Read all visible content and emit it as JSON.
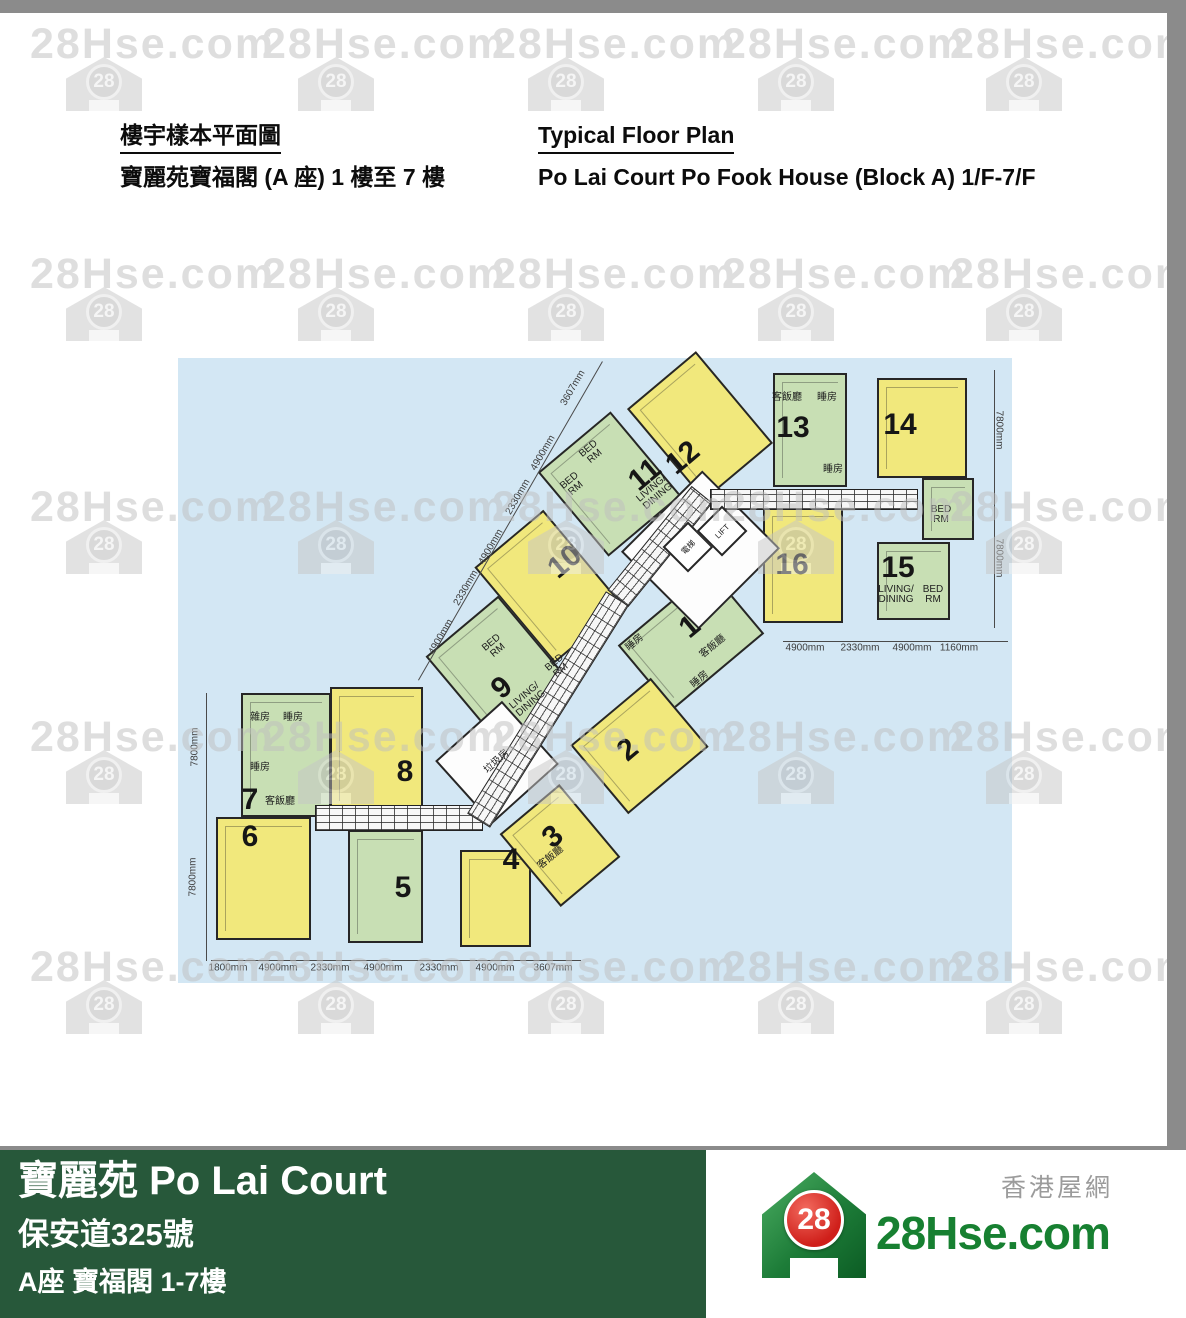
{
  "header": {
    "title_zh": "樓宇樣本平面圖",
    "subtitle_zh": "寶麗苑寶福閣 (A 座) 1 樓至 7 樓",
    "title_en": "Typical Floor Plan",
    "subtitle_en": "Po Lai Court Po Fook House (Block A) 1/F-7/F"
  },
  "watermark": {
    "text": "28Hse.com",
    "badge": "28",
    "cols": [
      30,
      262,
      492,
      722,
      950
    ],
    "rows": [
      20,
      250,
      483,
      713,
      943
    ]
  },
  "plan": {
    "bg": "#d3e7f4",
    "colors": {
      "yellow": "#f1e87c",
      "green": "#c8dfb4"
    },
    "units": [
      {
        "id": "7",
        "color": "green",
        "x": 63,
        "y": 335,
        "w": 90,
        "h": 124,
        "rot": 0
      },
      {
        "id": "6",
        "color": "yellow",
        "x": 38,
        "y": 459,
        "w": 95,
        "h": 123,
        "rot": 0
      },
      {
        "id": "8",
        "color": "yellow",
        "x": 152,
        "y": 329,
        "w": 93,
        "h": 123,
        "rot": 0
      },
      {
        "id": "5",
        "color": "green",
        "x": 170,
        "y": 472,
        "w": 75,
        "h": 113,
        "rot": 0
      },
      {
        "id": "4",
        "color": "yellow",
        "x": 282,
        "y": 492,
        "w": 71,
        "h": 97,
        "rot": 0
      },
      {
        "id": "13",
        "color": "green",
        "x": 595,
        "y": 15,
        "w": 74,
        "h": 114,
        "rot": 0
      },
      {
        "id": "14",
        "color": "yellow",
        "x": 699,
        "y": 20,
        "w": 90,
        "h": 100,
        "rot": 0
      },
      {
        "id": "14b",
        "color": "green",
        "x": 744,
        "y": 120,
        "w": 52,
        "h": 62,
        "rot": 0
      },
      {
        "id": "16",
        "color": "yellow",
        "x": 585,
        "y": 149,
        "w": 80,
        "h": 116,
        "rot": 0
      },
      {
        "id": "15",
        "color": "green",
        "x": 699,
        "y": 184,
        "w": 73,
        "h": 78,
        "rot": 0
      },
      {
        "id": "12",
        "color": "yellow",
        "cx": 522,
        "cy": 68,
        "w": 90,
        "h": 120,
        "rot": -40
      },
      {
        "id": "11",
        "color": "green",
        "cx": 431,
        "cy": 126,
        "w": 95,
        "h": 110,
        "rot": -40
      },
      {
        "id": "10",
        "color": "yellow",
        "cx": 371,
        "cy": 228,
        "w": 90,
        "h": 125,
        "rot": -40
      },
      {
        "id": "9",
        "color": "green",
        "cx": 322,
        "cy": 314,
        "w": 95,
        "h": 120,
        "rot": -40
      },
      {
        "id": "1",
        "color": "green",
        "cx": 513,
        "cy": 281,
        "w": 120,
        "h": 85,
        "rot": -40
      },
      {
        "id": "2",
        "color": "yellow",
        "cx": 461,
        "cy": 388,
        "w": 105,
        "h": 90,
        "rot": -40
      },
      {
        "id": "3",
        "color": "yellow",
        "cx": 382,
        "cy": 487,
        "w": 78,
        "h": 95,
        "rot": -40
      }
    ],
    "white_rooms": [
      {
        "id": "lift-lobby",
        "cx": 522,
        "cy": 192,
        "w": 115,
        "h": 110,
        "rot": -45
      },
      {
        "id": "refuse-stair",
        "cx": 319,
        "cy": 404,
        "w": 90,
        "h": 85,
        "rot": -42
      }
    ],
    "lift_cells": [
      {
        "label": "電梯",
        "cx": 510,
        "cy": 189,
        "w": 36,
        "h": 36,
        "rot": -45
      },
      {
        "label": "LIFT",
        "cx": 544,
        "cy": 173,
        "w": 36,
        "h": 36,
        "rot": -45
      }
    ],
    "corridors": [
      {
        "x": 137,
        "y": 447,
        "w": 168,
        "h": 26,
        "rot": 0
      },
      {
        "cx": 370,
        "cy": 351,
        "w": 262,
        "h": 27,
        "rot": -58
      },
      {
        "cx": 482,
        "cy": 188,
        "w": 134,
        "h": 27,
        "rot": -51
      },
      {
        "x": 532,
        "y": 131,
        "w": 208,
        "h": 21,
        "rot": 0
      }
    ],
    "unit_numbers": [
      {
        "n": "1",
        "x": 512,
        "y": 269,
        "rot": -40
      },
      {
        "n": "2",
        "x": 450,
        "y": 392,
        "rot": -40
      },
      {
        "n": "3",
        "x": 375,
        "y": 479,
        "rot": -40
      },
      {
        "n": "4",
        "x": 333,
        "y": 502,
        "rot": 0
      },
      {
        "n": "5",
        "x": 225,
        "y": 530,
        "rot": 0
      },
      {
        "n": "6",
        "x": 72,
        "y": 479,
        "rot": 0
      },
      {
        "n": "7",
        "x": 72,
        "y": 442,
        "rot": 0
      },
      {
        "n": "8",
        "x": 227,
        "y": 414,
        "rot": 0
      },
      {
        "n": "9",
        "x": 324,
        "y": 330,
        "rot": -40
      },
      {
        "n": "10",
        "x": 387,
        "y": 204,
        "rot": -40
      },
      {
        "n": "11",
        "x": 467,
        "y": 117,
        "rot": -40
      },
      {
        "n": "12",
        "x": 505,
        "y": 100,
        "rot": -40
      },
      {
        "n": "13",
        "x": 615,
        "y": 70,
        "rot": 0
      },
      {
        "n": "14",
        "x": 722,
        "y": 67,
        "rot": 0
      },
      {
        "n": "15",
        "x": 720,
        "y": 210,
        "rot": 0
      },
      {
        "n": "16",
        "x": 614,
        "y": 207,
        "rot": 0
      }
    ],
    "room_labels": [
      {
        "t": "雜房",
        "x": 82,
        "y": 360,
        "rot": 0
      },
      {
        "t": "睡房",
        "x": 115,
        "y": 360,
        "rot": 0
      },
      {
        "t": "睡房",
        "x": 82,
        "y": 410,
        "rot": 0
      },
      {
        "t": "客飯廳",
        "x": 102,
        "y": 444,
        "rot": 0
      },
      {
        "t": "客飯廳",
        "x": 609,
        "y": 40,
        "rot": 0
      },
      {
        "t": "睡房",
        "x": 649,
        "y": 40,
        "rot": 0
      },
      {
        "t": "睡房",
        "x": 655,
        "y": 112,
        "rot": 0
      },
      {
        "t": "BED\nRM",
        "x": 763,
        "y": 157,
        "rot": 0
      },
      {
        "t": "LIVING/\nDINING",
        "x": 718,
        "y": 237,
        "rot": 0
      },
      {
        "t": "BED\nRM",
        "x": 755,
        "y": 237,
        "rot": 0
      },
      {
        "t": "客飯廳",
        "x": 373,
        "y": 500,
        "rot": -40
      },
      {
        "t": "垃圾房",
        "x": 319,
        "y": 404,
        "rot": -42
      },
      {
        "t": "LIVING/\nDINING",
        "x": 477,
        "y": 135,
        "rot": -40
      },
      {
        "t": "BED\nRM",
        "x": 414,
        "y": 95,
        "rot": -40
      },
      {
        "t": "BED\nRM",
        "x": 395,
        "y": 127,
        "rot": -40
      },
      {
        "t": "BED\nRM",
        "x": 317,
        "y": 289,
        "rot": -40
      },
      {
        "t": "BED\nRM",
        "x": 380,
        "y": 309,
        "rot": -40
      },
      {
        "t": "LIVING/\nDINING",
        "x": 350,
        "y": 342,
        "rot": -40
      },
      {
        "t": "睡房",
        "x": 457,
        "y": 285,
        "rot": -40
      },
      {
        "t": "客飯廳",
        "x": 535,
        "y": 289,
        "rot": -40
      },
      {
        "t": "睡房",
        "x": 522,
        "y": 322,
        "rot": -40
      }
    ],
    "dim_labels": [
      {
        "t": "1800mm",
        "x": 50,
        "y": 610,
        "rot": 0
      },
      {
        "t": "4900mm",
        "x": 100,
        "y": 610,
        "rot": 0
      },
      {
        "t": "2330mm",
        "x": 152,
        "y": 610,
        "rot": 0
      },
      {
        "t": "4900mm",
        "x": 205,
        "y": 610,
        "rot": 0
      },
      {
        "t": "2330mm",
        "x": 261,
        "y": 610,
        "rot": 0
      },
      {
        "t": "4900mm",
        "x": 317,
        "y": 610,
        "rot": 0
      },
      {
        "t": "3607mm",
        "x": 375,
        "y": 610,
        "rot": 0
      },
      {
        "t": "4900mm",
        "x": 627,
        "y": 290,
        "rot": 0
      },
      {
        "t": "2330mm",
        "x": 682,
        "y": 290,
        "rot": 0
      },
      {
        "t": "4900mm",
        "x": 734,
        "y": 290,
        "rot": 0
      },
      {
        "t": "1160mm",
        "x": 781,
        "y": 290,
        "rot": 0
      },
      {
        "t": "7800mm",
        "x": 17,
        "y": 389,
        "rot": -90
      },
      {
        "t": "7800mm",
        "x": 15,
        "y": 519,
        "rot": -90
      },
      {
        "t": "7800mm",
        "x": 821,
        "y": 72,
        "rot": 90
      },
      {
        "t": "7800mm",
        "x": 821,
        "y": 200,
        "rot": 90
      },
      {
        "t": "3607mm",
        "x": 395,
        "y": 30,
        "rot": -60
      },
      {
        "t": "4900mm",
        "x": 365,
        "y": 95,
        "rot": -60
      },
      {
        "t": "2330mm",
        "x": 340,
        "y": 139,
        "rot": -60
      },
      {
        "t": "4900mm",
        "x": 313,
        "y": 189,
        "rot": -60
      },
      {
        "t": "2330mm",
        "x": 288,
        "y": 230,
        "rot": -60
      },
      {
        "t": "4900mm",
        "x": 263,
        "y": 279,
        "rot": -60
      }
    ],
    "dim_lines": [
      {
        "x": 33,
        "y": 602,
        "len": 370,
        "rot": 0
      },
      {
        "x": 605,
        "y": 283,
        "len": 225,
        "rot": 0
      },
      {
        "x": 29,
        "y": 335,
        "len": 268,
        "rot": 90
      },
      {
        "x": 817,
        "y": 12,
        "len": 258,
        "rot": 90
      },
      {
        "x": 240,
        "y": 322,
        "len": 368,
        "rot": -60
      }
    ]
  },
  "footer": {
    "title": "寶麗苑 Po Lai Court",
    "address": "保安道325號",
    "block": "A座 寶福閣 1-7樓",
    "logo": {
      "text": "28Hse.com",
      "badge": "28",
      "tagline": "香港屋網"
    }
  }
}
